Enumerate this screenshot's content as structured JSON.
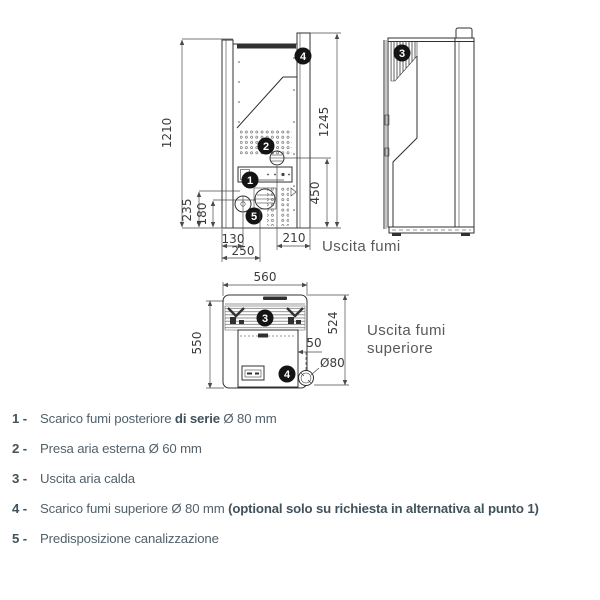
{
  "colors": {
    "line": "#2f3031",
    "dim": "#4a4a4a",
    "dimtext": "#3b3c3d",
    "label": "#58595b",
    "legend": "#52616b",
    "legend_bold": "#42525c",
    "badge": "#141414"
  },
  "diagram": {
    "rear_view": {
      "dim_height_left": "1210",
      "dim_height_right": "1245",
      "dim_flue_height": "450",
      "dim_duct_height": "235",
      "dim_flue_center_height": "180",
      "dim_duct_offset": "130",
      "dim_flue_offset": "250",
      "dim_air_offset": "210",
      "flue_label": "Uscita fumi",
      "badge_top_flue": "4",
      "badge_air_intake": "2",
      "badge_rear_flue": "1",
      "badge_duct": "5"
    },
    "side_view": {
      "badge_hot_air": "3"
    },
    "top_view": {
      "dim_width": "560",
      "dim_depth_total": "550",
      "dim_depth_body": "524",
      "dim_flue_gap": "50",
      "dim_flue_diameter": "Ø80",
      "flue_label_line1": "Uscita fumi",
      "flue_label_line2": "superiore",
      "badge_hot_air": "3",
      "badge_top_flue": "4"
    }
  },
  "legend": {
    "items": [
      {
        "num": "1",
        "dash": "-",
        "parts": [
          {
            "text": "Scarico fumi posteriore ",
            "bold": false
          },
          {
            "text": "di serie",
            "bold": true
          },
          {
            "text": " Ø 80 mm",
            "bold": false
          }
        ]
      },
      {
        "num": "2",
        "dash": "-",
        "parts": [
          {
            "text": "Presa aria esterna Ø 60 mm",
            "bold": false
          }
        ]
      },
      {
        "num": "3",
        "dash": "-",
        "parts": [
          {
            "text": "Uscita aria calda",
            "bold": false
          }
        ]
      },
      {
        "num": "4",
        "dash": "-",
        "parts": [
          {
            "text": "Scarico fumi superiore Ø 80 mm ",
            "bold": false
          },
          {
            "text": "(optional solo su richiesta in alternativa al punto 1)",
            "bold": true
          }
        ]
      },
      {
        "num": "5",
        "dash": "-",
        "parts": [
          {
            "text": "Predisposizione canalizzazione",
            "bold": false
          }
        ]
      }
    ]
  }
}
